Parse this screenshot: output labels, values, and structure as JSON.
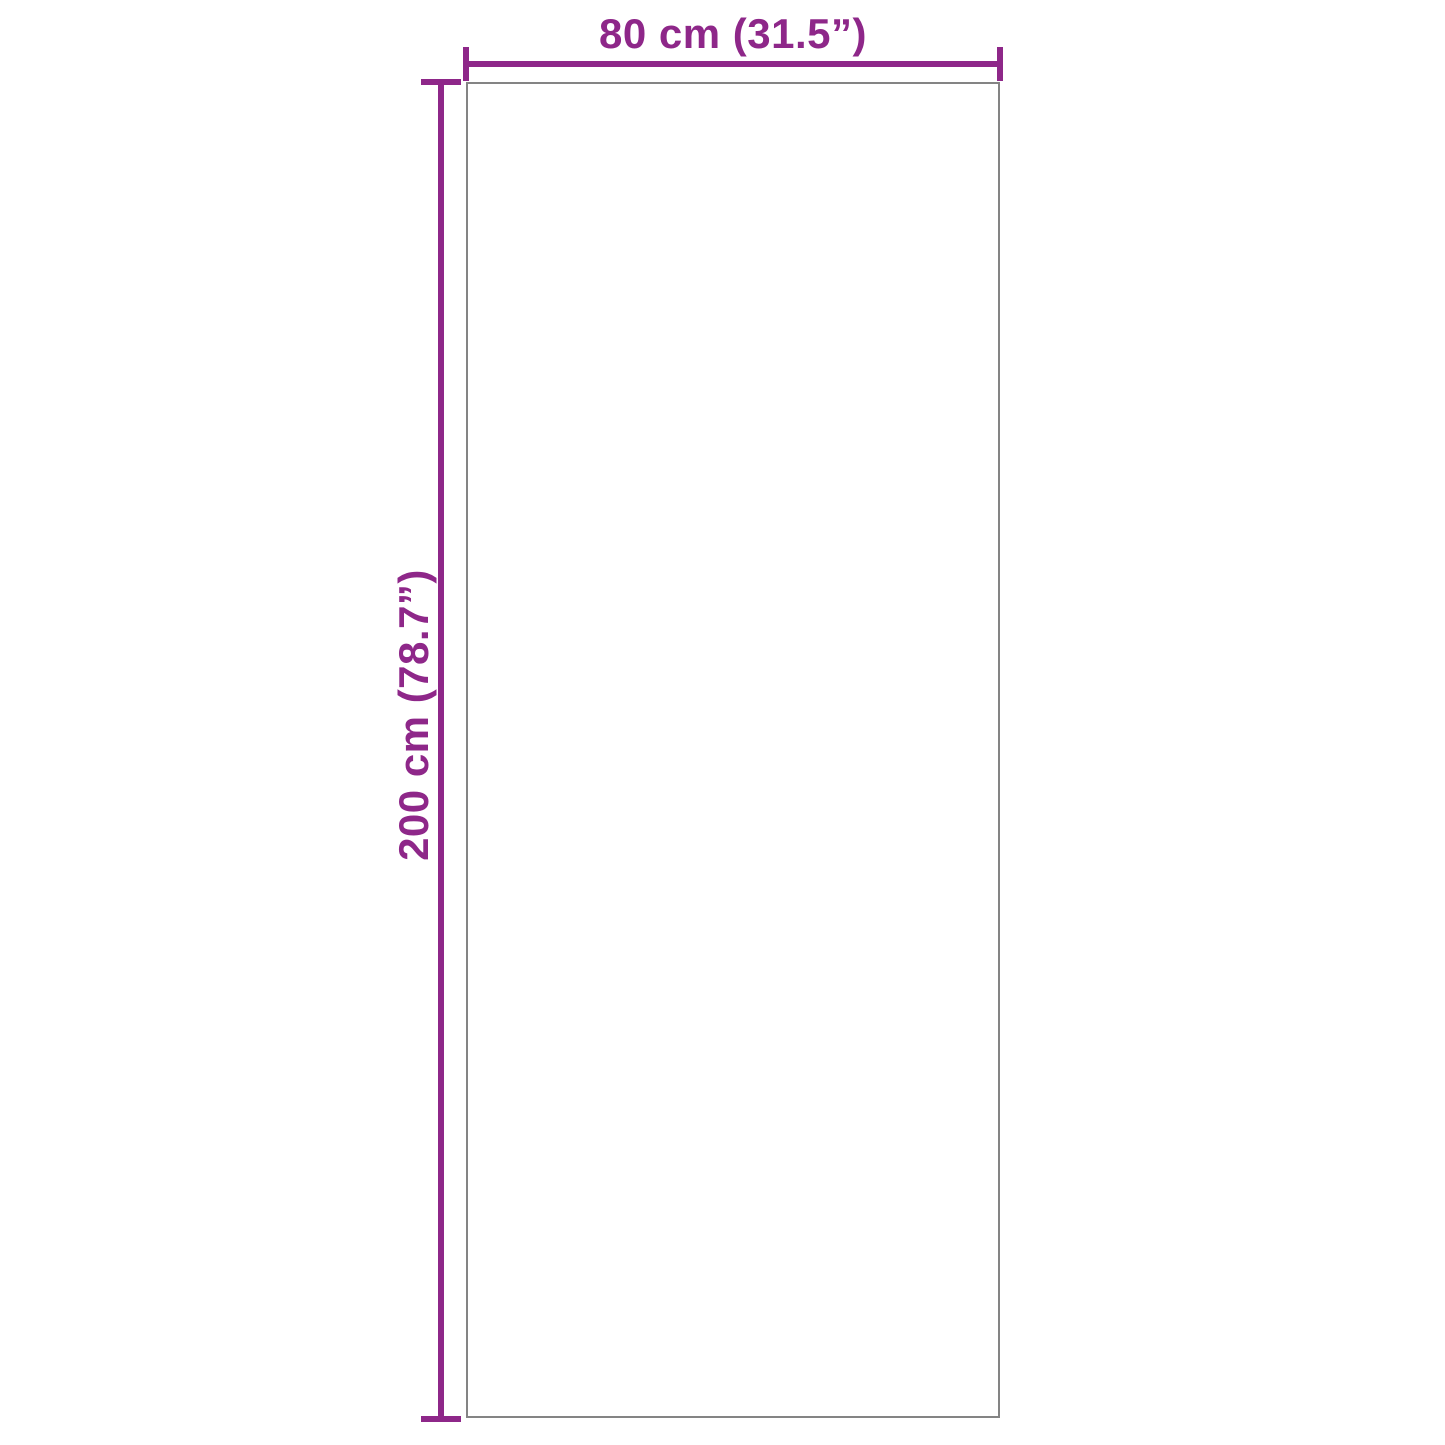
{
  "diagram": {
    "type": "product-dimension-diagram",
    "shape": "rectangle",
    "width_label": "80 cm (31.5”)",
    "height_label": "200 cm (78.7”)",
    "width_value_cm": 80,
    "width_value_inch": 31.5,
    "height_value_cm": 200,
    "height_value_inch": 78.7,
    "colors": {
      "dimension": "#8e2789",
      "outline": "#848484",
      "background": "#ffffff"
    }
  }
}
